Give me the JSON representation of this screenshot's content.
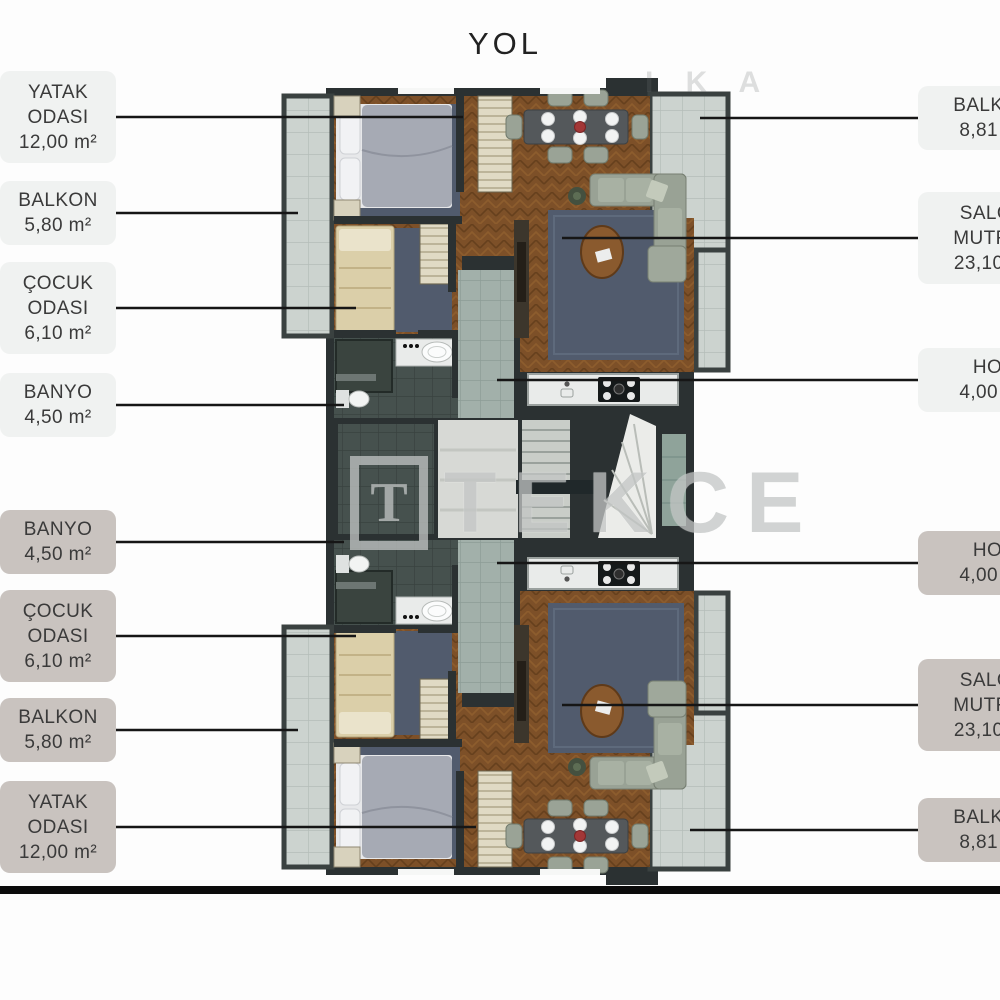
{
  "page_title": "YOL",
  "watermark": {
    "logo_letter": "T",
    "brand": "TEKCE",
    "faint_fragment": "I K A"
  },
  "labels": {
    "left": [
      {
        "lines": [
          "YATAK",
          "ODASI"
        ],
        "area": "12,00 m²",
        "tone": "light"
      },
      {
        "lines": [
          "BALKON"
        ],
        "area": "5,80 m²",
        "tone": "light"
      },
      {
        "lines": [
          "ÇOCUK",
          "ODASI"
        ],
        "area": "6,10 m²",
        "tone": "light"
      },
      {
        "lines": [
          "BANYO"
        ],
        "area": "4,50 m²",
        "tone": "light"
      },
      {
        "lines": [
          "BANYO"
        ],
        "area": "4,50 m²",
        "tone": "dark"
      },
      {
        "lines": [
          "ÇOCUK",
          "ODASI"
        ],
        "area": "6,10 m²",
        "tone": "dark"
      },
      {
        "lines": [
          "BALKON"
        ],
        "area": "5,80 m²",
        "tone": "dark"
      },
      {
        "lines": [
          "YATAK",
          "ODASI"
        ],
        "area": "12,00 m²",
        "tone": "dark"
      }
    ],
    "right": [
      {
        "lines": [
          "BALKON"
        ],
        "area": "8,81 m²",
        "tone": "light"
      },
      {
        "lines": [
          "SALON",
          "MUTFAK"
        ],
        "area": "23,10 m²",
        "tone": "light"
      },
      {
        "lines": [
          "HOL"
        ],
        "area": "4,00 m²",
        "tone": "light"
      },
      {
        "lines": [
          "HOL"
        ],
        "area": "4,00 m²",
        "tone": "dark"
      },
      {
        "lines": [
          "SALON",
          "MUTFAK"
        ],
        "area": "23,10 m²",
        "tone": "dark"
      },
      {
        "lines": [
          "BALKON"
        ],
        "area": "8,81 m²",
        "tone": "dark"
      }
    ]
  },
  "colors": {
    "label_light": "#f0f2f1",
    "label_dark": "#c9c3bf",
    "wall": "#2b3132",
    "wood": "#7d5028",
    "balcony_tile": "#ccd3cf",
    "bath_tile": "#46514e",
    "hall_tile": "#a2b0aa",
    "rug": "#515b6d",
    "sofa": "#99a295",
    "accent_red": "#a23737",
    "leader_line": "#161616"
  }
}
